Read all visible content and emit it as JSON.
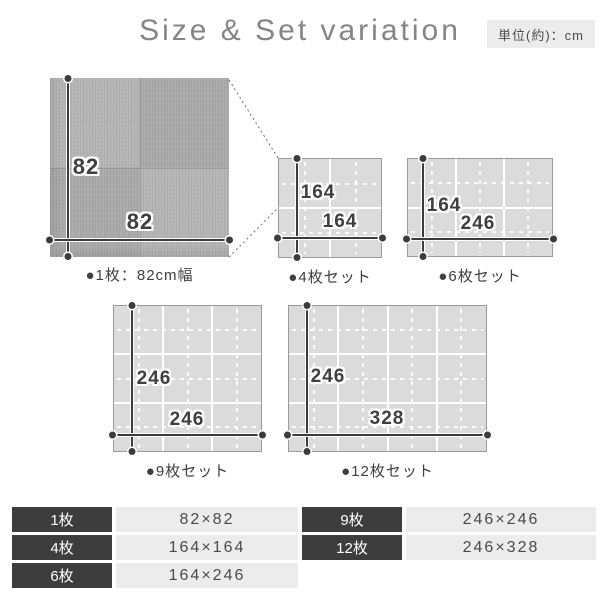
{
  "header": {
    "title": "Size & Set variation",
    "unit_label": "単位(約)：cm"
  },
  "single_mat": {
    "caption": "●1枚：82cm幅",
    "width_label": "82",
    "height_label": "82",
    "pieces": 1
  },
  "sets": [
    {
      "caption": "●4枚セット",
      "width_label": "164",
      "height_label": "164",
      "cols": 2,
      "rows": 2,
      "pieces": 4
    },
    {
      "caption": "●6枚セット",
      "width_label": "246",
      "height_label": "164",
      "cols": 3,
      "rows": 2,
      "pieces": 6
    },
    {
      "caption": "●9枚セット",
      "width_label": "246",
      "height_label": "246",
      "cols": 3,
      "rows": 3,
      "pieces": 9
    },
    {
      "caption": "●12枚セット",
      "width_label": "328",
      "height_label": "246",
      "cols": 4,
      "rows": 3,
      "pieces": 12
    }
  ],
  "size_table": {
    "left_rows": [
      {
        "label": "1枚",
        "size": "82×82"
      },
      {
        "label": "4枚",
        "size": "164×164"
      },
      {
        "label": "6枚",
        "size": "164×246"
      }
    ],
    "right_rows": [
      {
        "label": "9枚",
        "size": "246×246"
      },
      {
        "label": "12枚",
        "size": "246×328"
      }
    ]
  },
  "colors": {
    "accent_dark": "#3d3d3d",
    "table_light_bg": "#ececec",
    "set_mat_fill": "#dbdbdb",
    "mat_border": "#9a9a9a",
    "single_mat_fill": "#b2b2b2",
    "dimension_line": "#3c3c3c",
    "title_gray": "#858585"
  }
}
